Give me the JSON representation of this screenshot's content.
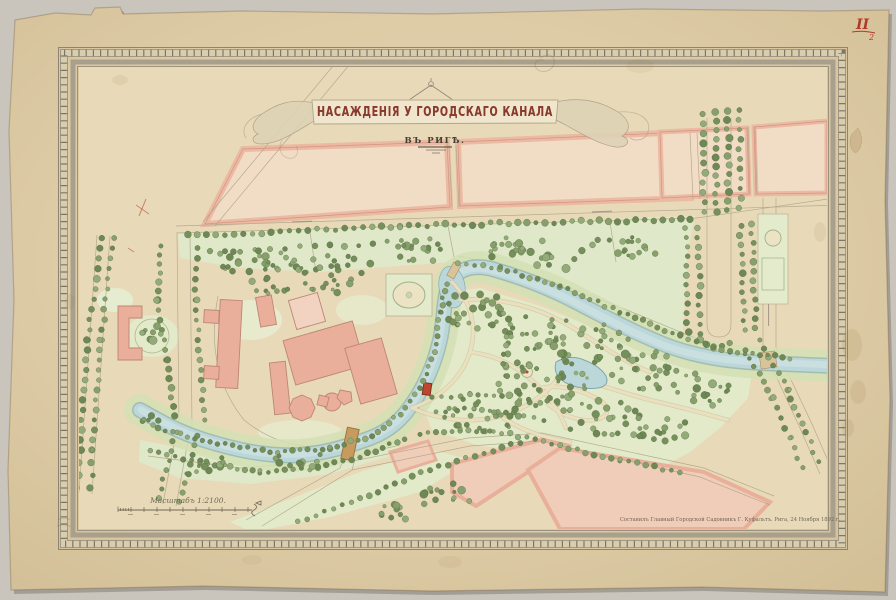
{
  "page": {
    "title": "НАСАЖДЕНІЯ У ГОРОДСКАГО КАНАЛА",
    "subtitle": "ВЪ РИГѢ.",
    "corner_mark": "II",
    "corner_mark_index": "2",
    "scale_label": "Масштабъ 1:2100.",
    "credit_line": "Составилъ Главный Городской Садовникъ Г. Куфальтъ.  Рига, 24 Ноября 1892 г."
  },
  "colors": {
    "paper": "#decca7",
    "map_ground": "#e8dab8",
    "frame_line": "#8d8573",
    "water": "#bcd7da",
    "water_edge": "#7fa6ad",
    "park_green": "#dfe8c8",
    "bank_green": "#d4dfb4",
    "block_pink": "#ecb9a3",
    "building_pink": "#e9af9b",
    "bridge_brown": "#c79a5e",
    "title_red": "#8a3a2c",
    "accent_red": "#b03a2a",
    "tree_palette": [
      "#87a06b",
      "#76905c",
      "#93ab78",
      "#6d8854"
    ]
  }
}
